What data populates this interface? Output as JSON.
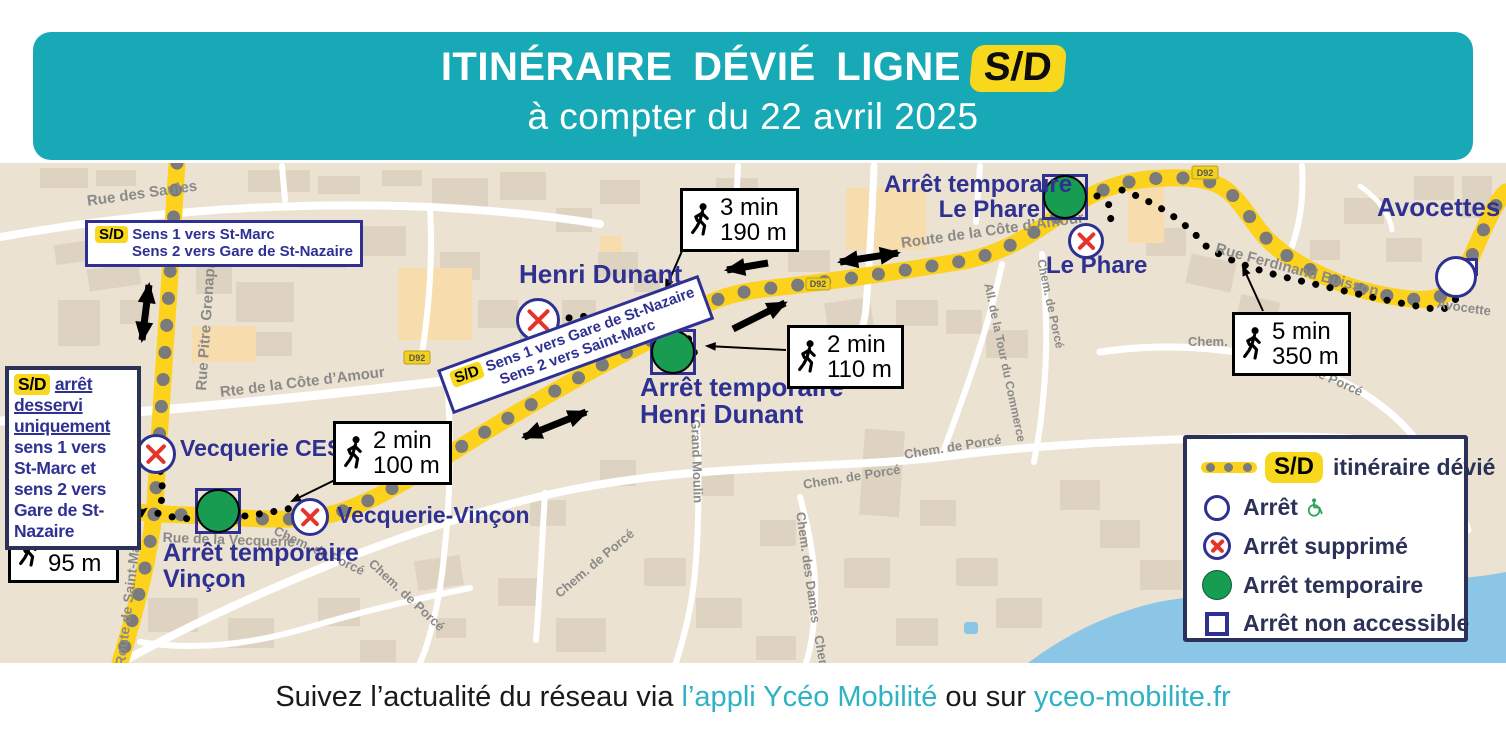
{
  "colors": {
    "teal": "#17a9b6",
    "route_yellow": "#fcd21c",
    "badge_yellow": "#f8d81c",
    "stop_navy": "#2e3192",
    "dark_navy": "#2b3157",
    "suppressed_red": "#e5332a",
    "temporary_green": "#189c52",
    "water_blue": "#8cc6e6",
    "map_bg": "#ece2d2",
    "link_teal": "#2fb3c2"
  },
  "header": {
    "title": "ITINÉRAIRE DÉVIÉ LIGNE",
    "line_badge": "S/D",
    "subtitle": "à compter du 22 avril 2025"
  },
  "footer": {
    "prefix": "Suivez l’actualité du réseau via ",
    "link_app": "l’appli Ycéo Mobilité",
    "middle": " ou sur ",
    "link_site": "yceo-mobilite.fr"
  },
  "direction_boxes": {
    "north": {
      "badge": "S/D",
      "line1": "Sens 1 vers St-Marc",
      "line2": "Sens 2 vers Gare de St-Nazaire"
    },
    "diagonal": {
      "badge": "S/D",
      "line1": "Sens 1 vers Gare de St-Nazaire",
      "line2": "Sens 2 vers Saint-Marc"
    },
    "note": {
      "badge": "S/D",
      "underlined1": "arrêt desservi",
      "underlined2": "uniquement",
      "rest": " sens 1 vers St-Marc et sens 2 vers Gare de St-Nazaire"
    }
  },
  "walk_boxes": [
    {
      "time": "3 min",
      "distance": "190 m"
    },
    {
      "time": "2 min",
      "distance": "110 m"
    },
    {
      "time": "5 min",
      "distance": "350 m"
    },
    {
      "time": "2 min",
      "distance": "100 m"
    },
    {
      "time": "2 min",
      "distance": "95 m"
    }
  ],
  "stops": [
    {
      "label": "Vecquerie CES",
      "status": "supprimé"
    },
    {
      "label": "Vecquerie-Vinçon",
      "status": "supprimé"
    },
    {
      "label_line1": "Arrêt temporaire",
      "label_line2": "Vinçon",
      "status": "temporaire"
    },
    {
      "label": "Henri Dunant",
      "status": "supprimé"
    },
    {
      "label_line1": "Arrêt temporaire",
      "label_line2": "Henri Dunant",
      "status": "temporaire"
    },
    {
      "label": "Le Phare",
      "status": "supprimé"
    },
    {
      "label_line1": "Arrêt temporaire",
      "label_line2": "Le Phare",
      "status": "temporaire"
    },
    {
      "label": "Avocettes",
      "status": "arrêt"
    }
  ],
  "legend": {
    "route_badge": "S/D",
    "route_label": "itinéraire dévié",
    "items": [
      {
        "label": "Arrêt"
      },
      {
        "label": "Arrêt supprimé"
      },
      {
        "label": "Arrêt temporaire"
      },
      {
        "label": "Arrêt non accessible"
      }
    ]
  },
  "road_shields": [
    {
      "label": "D92"
    },
    {
      "label": "D92"
    },
    {
      "label": "D92"
    },
    {
      "label": "D92"
    }
  ],
  "streets": [
    {
      "name": "Rue des Saules"
    },
    {
      "name": "Rue Pitre Grenapin"
    },
    {
      "name": "Rte de la Côte d’Amour"
    },
    {
      "name": "Route de la Côte d’Amour"
    },
    {
      "name": "Route de Saint-Marc"
    },
    {
      "name": "Rue de la Vecquerie"
    },
    {
      "name": "Chem. de Porcé"
    },
    {
      "name": "Chem. de Porcé"
    },
    {
      "name": "Chem. de Porcé"
    },
    {
      "name": "Chem. de Porcé"
    },
    {
      "name": "Chem. de Porcé"
    },
    {
      "name": "Grand Moulin"
    },
    {
      "name": "Chem. des Dames"
    },
    {
      "name": "Chem."
    },
    {
      "name": "All. de la Tour du Commerce"
    },
    {
      "name": "Chem. de Porcé"
    },
    {
      "name": "Chem. d"
    },
    {
      "name": "de Porcé"
    },
    {
      "name": "Rue Ferdinand Buisson"
    },
    {
      "name": "Avocette"
    }
  ]
}
